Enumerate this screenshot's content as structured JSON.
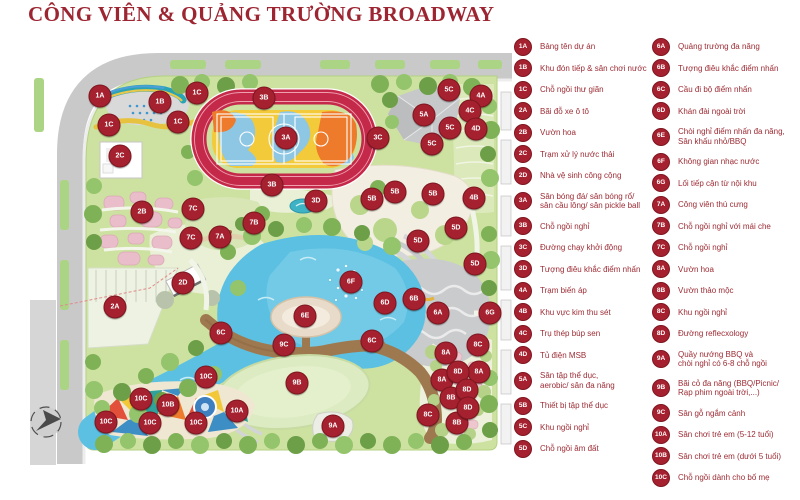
{
  "title": "CÔNG VIÊN & QUẢNG TRƯỜNG BROADWAY",
  "colors": {
    "accent_red": "#9c2531",
    "marker_red": "#a6212f"
  },
  "legend": {
    "columns": [
      {
        "items": [
          {
            "code": "1A",
            "label": "Bảng tên dự án"
          },
          {
            "code": "1B",
            "label": "Khu đón tiếp & sân chơi nước"
          },
          {
            "code": "1C",
            "label": "Chỗ ngồi thư giãn"
          },
          {
            "code": "2A",
            "label": "Bãi đỗ xe ô tô"
          },
          {
            "code": "2B",
            "label": "Vườn hoa"
          },
          {
            "code": "2C",
            "label": "Trạm xử lý nước thải"
          },
          {
            "code": "2D",
            "label": "Nhà vệ sinh công cộng"
          },
          {
            "code": "3A",
            "label": "Sân bóng đá/ sân bóng rổ/\nsân cầu lông/ sân pickle ball"
          },
          {
            "code": "3B",
            "label": "Chỗ ngồi nghỉ"
          },
          {
            "code": "3C",
            "label": "Đường chạy khởi động"
          },
          {
            "code": "3D",
            "label": "Tượng điêu khắc điểm nhấn"
          },
          {
            "code": "4A",
            "label": "Trạm biến áp"
          },
          {
            "code": "4B",
            "label": "Khu vực kim thu sét"
          },
          {
            "code": "4C",
            "label": "Trụ thép búp sen"
          },
          {
            "code": "4D",
            "label": "Tủ điện MSB"
          },
          {
            "code": "5A",
            "label": "Sân tập thể dục,\naerobic/ sân đa năng"
          },
          {
            "code": "5B",
            "label": "Thiết bị tập thể dục"
          },
          {
            "code": "5C",
            "label": "Khu ngồi nghỉ"
          },
          {
            "code": "5D",
            "label": "Chỗ ngồi âm đất"
          }
        ]
      },
      {
        "items": [
          {
            "code": "6A",
            "label": "Quảng trường đa năng"
          },
          {
            "code": "6B",
            "label": "Tượng điêu khắc điểm nhấn"
          },
          {
            "code": "6C",
            "label": "Cầu đi bộ điểm nhấn"
          },
          {
            "code": "6D",
            "label": "Khán đài ngoài trời"
          },
          {
            "code": "6E",
            "label": "Chòi nghỉ điểm nhấn đa năng,\nSân khấu nhỏ/BBQ"
          },
          {
            "code": "6F",
            "label": "Không gian nhạc nước"
          },
          {
            "code": "6G",
            "label": "Lối tiếp cận từ nội khu"
          },
          {
            "code": "7A",
            "label": "Công viên thú cưng"
          },
          {
            "code": "7B",
            "label": "Chỗ ngồi nghỉ với mái che"
          },
          {
            "code": "7C",
            "label": "Chỗ ngồi nghỉ"
          },
          {
            "code": "8A",
            "label": "Vườn hoa"
          },
          {
            "code": "8B",
            "label": "Vườn thảo mộc"
          },
          {
            "code": "8C",
            "label": "Khu ngồi nghỉ"
          },
          {
            "code": "8D",
            "label": "Đường reflecxology"
          },
          {
            "code": "9A",
            "label": "Quầy nướng BBQ và\nchòi nghỉ có 6-8 chỗ ngồi"
          },
          {
            "code": "9B",
            "label": "Bãi cỏ đa năng (BBQ/Picnic/\nRạp phim ngoài trời,...)"
          },
          {
            "code": "9C",
            "label": "Sân gỗ ngắm cảnh"
          },
          {
            "code": "10A",
            "label": "Sân chơi trẻ em (5-12 tuổi)"
          },
          {
            "code": "10B",
            "label": "Sân chơi trẻ em (dưới 5 tuổi)"
          },
          {
            "code": "10C",
            "label": "Chỗ ngồi dành cho bố mẹ"
          }
        ]
      }
    ]
  },
  "map": {
    "markers": [
      {
        "code": "1A",
        "x": 100,
        "y": 96
      },
      {
        "code": "1B",
        "x": 160,
        "y": 102
      },
      {
        "code": "1C",
        "x": 197,
        "y": 93
      },
      {
        "code": "1C",
        "x": 178,
        "y": 122
      },
      {
        "code": "1C",
        "x": 109,
        "y": 125
      },
      {
        "code": "2A",
        "x": 115,
        "y": 307
      },
      {
        "code": "2B",
        "x": 142,
        "y": 212
      },
      {
        "code": "2C",
        "x": 120,
        "y": 156
      },
      {
        "code": "2D",
        "x": 183,
        "y": 283
      },
      {
        "code": "3A",
        "x": 286,
        "y": 138
      },
      {
        "code": "3B",
        "x": 264,
        "y": 98
      },
      {
        "code": "3B",
        "x": 272,
        "y": 185
      },
      {
        "code": "3C",
        "x": 378,
        "y": 138
      },
      {
        "code": "3D",
        "x": 316,
        "y": 201
      },
      {
        "code": "4A",
        "x": 481,
        "y": 96
      },
      {
        "code": "4B",
        "x": 474,
        "y": 198
      },
      {
        "code": "4C",
        "x": 470,
        "y": 111
      },
      {
        "code": "4D",
        "x": 476,
        "y": 129
      },
      {
        "code": "5A",
        "x": 424,
        "y": 115
      },
      {
        "code": "5B",
        "x": 372,
        "y": 199
      },
      {
        "code": "5B",
        "x": 395,
        "y": 192
      },
      {
        "code": "5B",
        "x": 433,
        "y": 194
      },
      {
        "code": "5C",
        "x": 449,
        "y": 90
      },
      {
        "code": "5C",
        "x": 450,
        "y": 128
      },
      {
        "code": "5C",
        "x": 432,
        "y": 144
      },
      {
        "code": "5D",
        "x": 456,
        "y": 228
      },
      {
        "code": "5D",
        "x": 418,
        "y": 241
      },
      {
        "code": "5D",
        "x": 475,
        "y": 264
      },
      {
        "code": "6A",
        "x": 438,
        "y": 313
      },
      {
        "code": "6B",
        "x": 414,
        "y": 299
      },
      {
        "code": "6C",
        "x": 221,
        "y": 333
      },
      {
        "code": "6C",
        "x": 372,
        "y": 341
      },
      {
        "code": "6D",
        "x": 385,
        "y": 303
      },
      {
        "code": "6E",
        "x": 305,
        "y": 316
      },
      {
        "code": "6F",
        "x": 351,
        "y": 282
      },
      {
        "code": "6G",
        "x": 490,
        "y": 313
      },
      {
        "code": "7A",
        "x": 220,
        "y": 237
      },
      {
        "code": "7B",
        "x": 254,
        "y": 223
      },
      {
        "code": "7C",
        "x": 193,
        "y": 209
      },
      {
        "code": "7C",
        "x": 191,
        "y": 238
      },
      {
        "code": "8A",
        "x": 446,
        "y": 353
      },
      {
        "code": "8A",
        "x": 479,
        "y": 372
      },
      {
        "code": "8A",
        "x": 442,
        "y": 380
      },
      {
        "code": "8B",
        "x": 451,
        "y": 398
      },
      {
        "code": "8B",
        "x": 457,
        "y": 423
      },
      {
        "code": "8C",
        "x": 478,
        "y": 345
      },
      {
        "code": "8C",
        "x": 428,
        "y": 415
      },
      {
        "code": "8D",
        "x": 458,
        "y": 372
      },
      {
        "code": "8D",
        "x": 467,
        "y": 390
      },
      {
        "code": "8D",
        "x": 468,
        "y": 408
      },
      {
        "code": "9A",
        "x": 333,
        "y": 426
      },
      {
        "code": "9B",
        "x": 297,
        "y": 383
      },
      {
        "code": "9C",
        "x": 284,
        "y": 345
      },
      {
        "code": "10A",
        "x": 237,
        "y": 411
      },
      {
        "code": "10B",
        "x": 168,
        "y": 405
      },
      {
        "code": "10C",
        "x": 206,
        "y": 377
      },
      {
        "code": "10C",
        "x": 141,
        "y": 399
      },
      {
        "code": "10C",
        "x": 106,
        "y": 422
      },
      {
        "code": "10C",
        "x": 150,
        "y": 423
      },
      {
        "code": "10C",
        "x": 196,
        "y": 423
      }
    ]
  }
}
